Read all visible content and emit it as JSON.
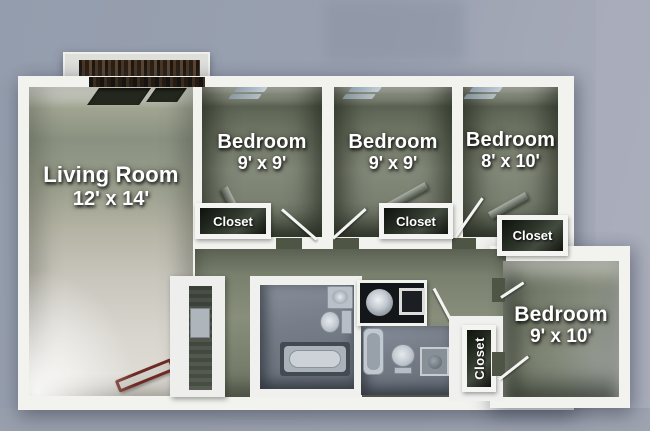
{
  "image_type": "3d-floor-plan",
  "rooms": {
    "living": {
      "name": "Living Room",
      "dims": "12' x 14'"
    },
    "bedroom1": {
      "name": "Bedroom",
      "dims": "9' x 9'"
    },
    "bedroom2": {
      "name": "Bedroom",
      "dims": "9' x 9'"
    },
    "bedroom3": {
      "name": "Bedroom",
      "dims": "8' x 10'"
    },
    "bedroom4": {
      "name": "Bedroom",
      "dims": "9' x 10'"
    }
  },
  "closets": {
    "c1": {
      "label": "Closet"
    },
    "c2": {
      "label": "Closet"
    },
    "c3": {
      "label": "Closet"
    },
    "c4": {
      "label": "Closet"
    }
  },
  "colors": {
    "background": "#99a1b0",
    "wall_white": "#f2f2ef",
    "bedroom_floor": "#7e8576",
    "living_floor": "#d3d0c9",
    "hall_floor": "#79806e",
    "bath_floor": "#767d88",
    "closet_badge_bg": "#11150e",
    "label_text": "#ffffff",
    "balcony_wood": "#4a3726",
    "bench_outline": "#6e2a22"
  }
}
